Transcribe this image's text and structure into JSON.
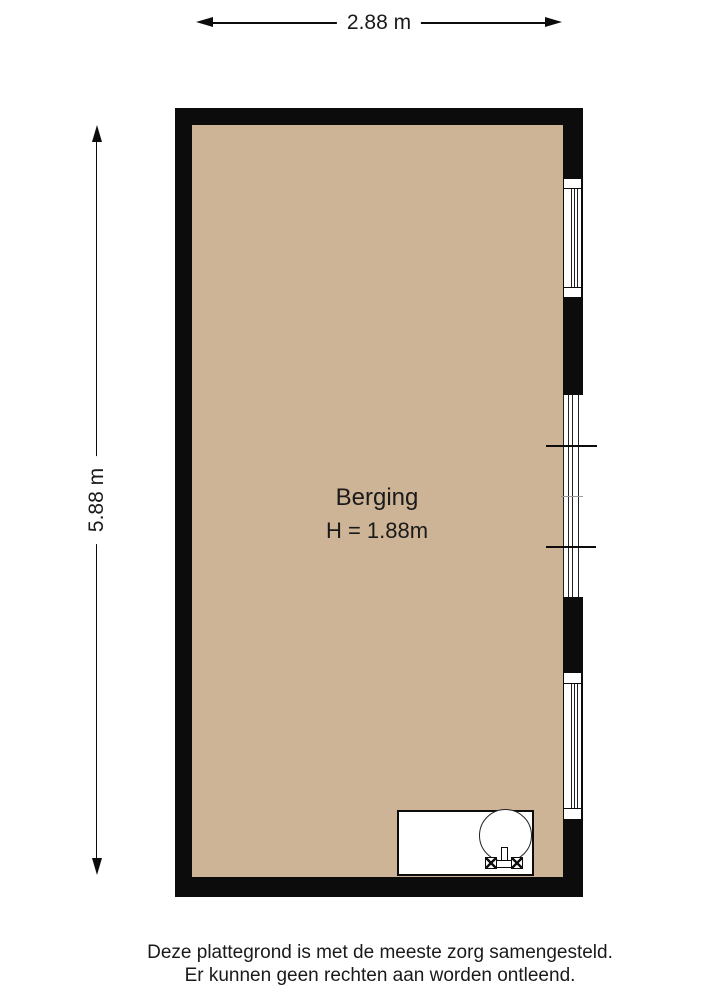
{
  "dimensions": {
    "width": {
      "label": "2.88 m"
    },
    "height": {
      "label": "5.88 m"
    }
  },
  "room": {
    "name": "Berging",
    "ceiling_height": "H = 1.88m"
  },
  "footer": {
    "line1": "Deze plattegrond is met de meeste zorg samengesteld.",
    "line2": "Er kunnen geen rechten aan worden ontleend."
  },
  "colors": {
    "background": "#ffffff",
    "wall": "#0c0c0c",
    "floor": "#cdb496",
    "glass_line": "#222222",
    "text": "#1a1a1a"
  }
}
